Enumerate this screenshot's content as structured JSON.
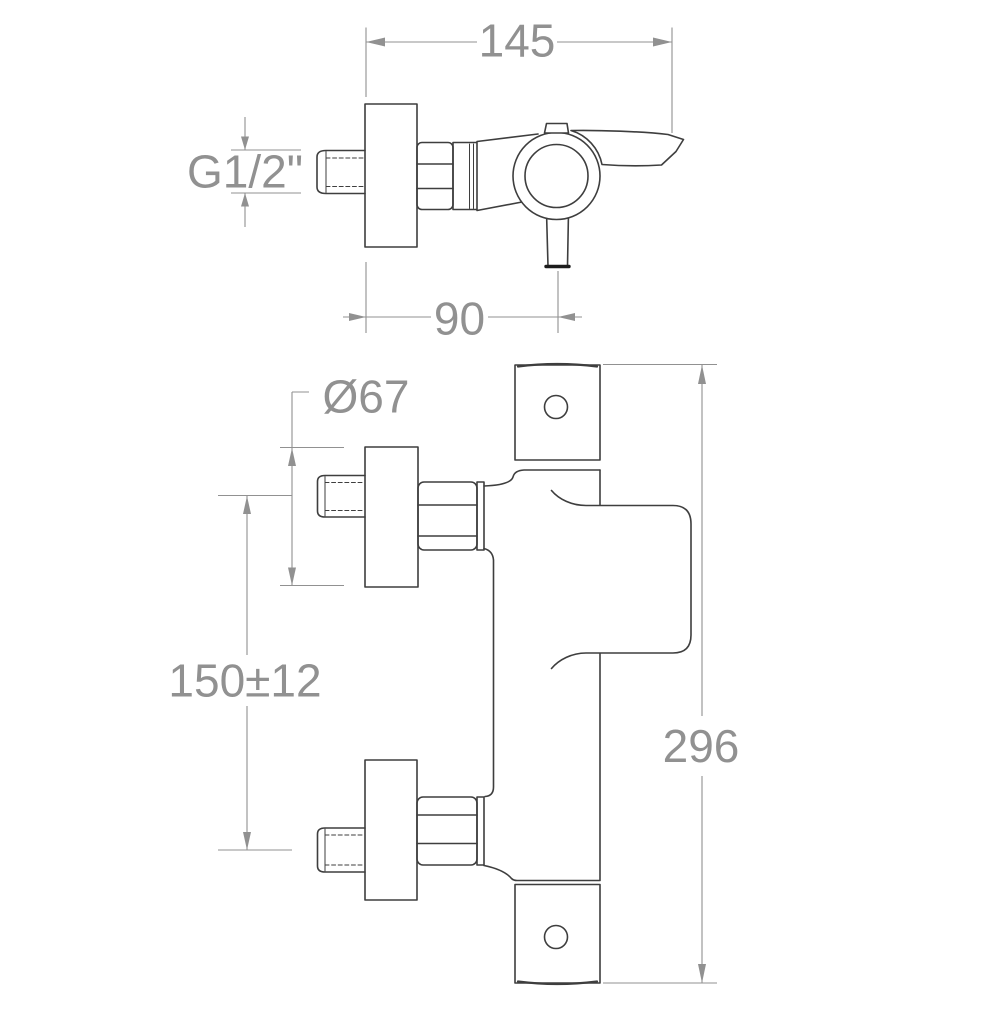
{
  "colors": {
    "background": "#ffffff",
    "outline": "#3e3e3e",
    "dimension": "#919191",
    "emphasis": "#1c1c1c"
  },
  "views": {
    "top": {
      "dims": {
        "overall_width": "145",
        "thread_size": "G1/2\"",
        "wall_to_outlet": "90"
      }
    },
    "front": {
      "dims": {
        "flange_diameter": "Ø67",
        "inlet_spacing": "150±12",
        "overall_height": "296"
      }
    }
  }
}
